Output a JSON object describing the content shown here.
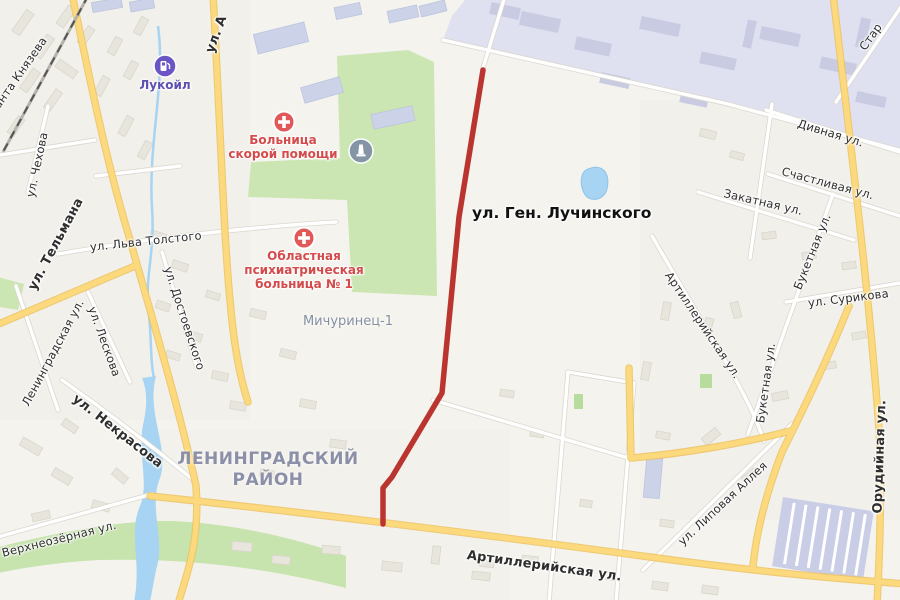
{
  "map": {
    "title_street": "ул. Ген. Лучинского",
    "district": "ЛЕНИНГРАДСКИЙ\nРАЙОН",
    "neighborhood": "Мичуринец-1",
    "pois": {
      "fuel": {
        "label": "Лукойл"
      },
      "er_hospital": {
        "label": "Больница\nскорой помощи"
      },
      "psy_hospital": {
        "label": "Областная\nпсихиатрическая\nбольница № 1"
      }
    },
    "streets": [
      {
        "text": "ул. А"
      },
      {
        "text": "анта Князева"
      },
      {
        "text": "ул. Чехова"
      },
      {
        "text": "ул. Тельмана"
      },
      {
        "text": "ул. Льва Толстого"
      },
      {
        "text": "ул. Достоевского"
      },
      {
        "text": "ул. Лескова"
      },
      {
        "text": "Ленинградская ул."
      },
      {
        "text": "ул. Некрасова"
      },
      {
        "text": "Верхнеозёрная ул."
      },
      {
        "text": "Артиллерийская ул."
      },
      {
        "text": "Артиллерийская ул."
      },
      {
        "text": "Букетная ул."
      },
      {
        "text": "Букетная ул."
      },
      {
        "text": "ул. Сурикова"
      },
      {
        "text": "Закатная ул."
      },
      {
        "text": "Счастливая ул."
      },
      {
        "text": "Дивная ул."
      },
      {
        "text": "ул. Липовая Аллея"
      },
      {
        "text": "Орудийная ул."
      },
      {
        "text": "Стар"
      }
    ],
    "colors": {
      "route": "#bb3530",
      "major_road": "#fcd97c",
      "water": "#a6d4f2",
      "park": "#cbe6b3",
      "industrial": "#dfe0f0",
      "poi_red": "#e25757",
      "fuel_purple": "#6b55c5",
      "district_text": "#8b90a8"
    }
  }
}
